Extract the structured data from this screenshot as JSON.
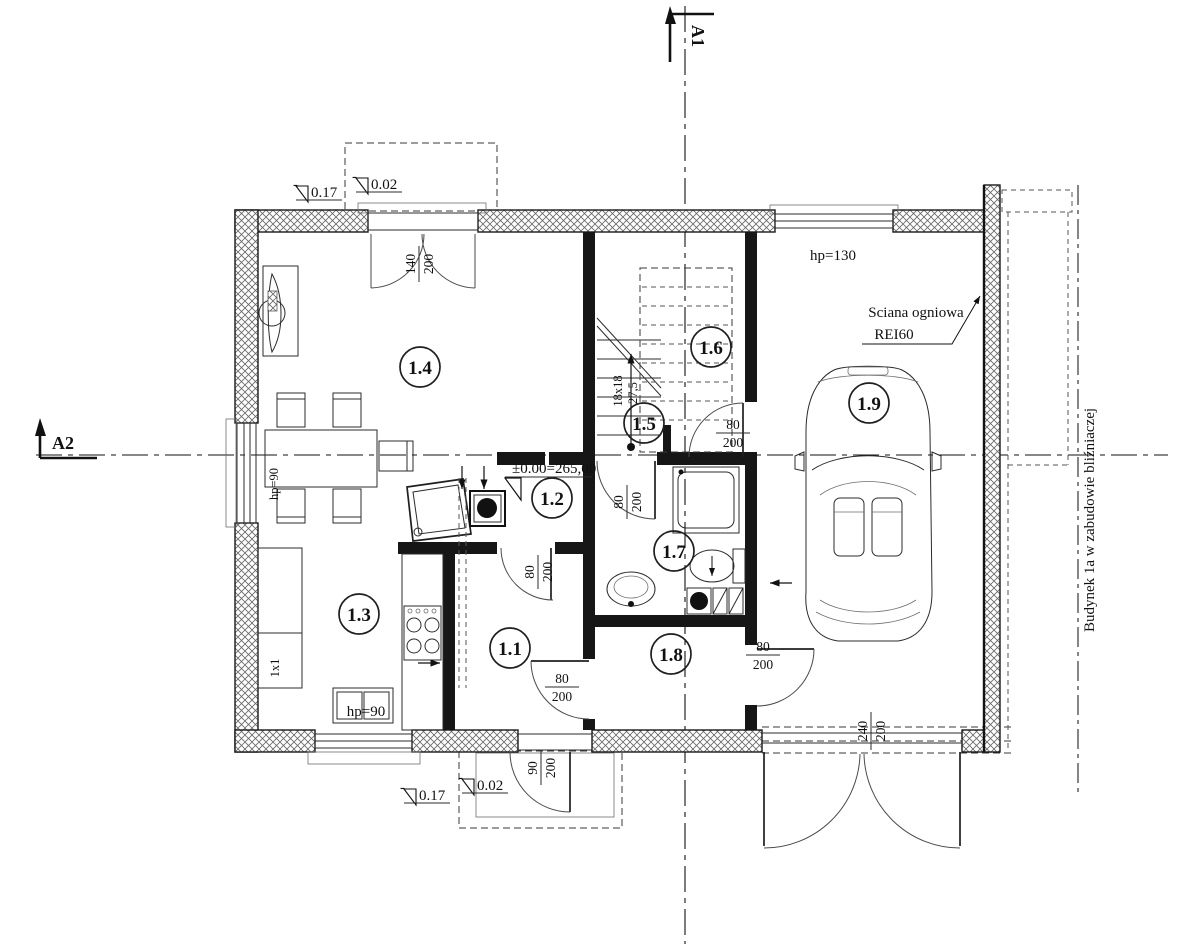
{
  "sections": {
    "a1": "A1",
    "a2": "A2"
  },
  "rooms": {
    "r11": "1.1",
    "r12": "1.2",
    "r13": "1.3",
    "r14": "1.4",
    "r15": "1.5",
    "r16": "1.6",
    "r17": "1.7",
    "r18": "1.8",
    "r19": "1.9"
  },
  "levels": {
    "minus": "-",
    "top_outer": "0.17",
    "top_inner": "0.02",
    "main": "±0.00=265,00",
    "bottom_inner": "0.02",
    "bottom_outer": "0.17"
  },
  "dims": {
    "balcony": {
      "w": "140",
      "h": "200"
    },
    "garage_door": {
      "w": "240",
      "h": "200"
    },
    "entrance": {
      "w": "90",
      "h": "200"
    },
    "door16": {
      "w": "80",
      "h": "200"
    },
    "door_bath": {
      "w": "80",
      "h": "200"
    },
    "door11": {
      "w": "80",
      "h": "200"
    },
    "door18a": {
      "w": "80",
      "h": "200"
    },
    "door18b": {
      "w": "80",
      "h": "200"
    }
  },
  "annotations": {
    "hp130": "hp=130",
    "hp90_window": "hp=90",
    "hp90_sink": "hp=90",
    "firewall_line1": "Sciana ogniowa",
    "firewall_line2": "REI60",
    "stair_steps": "18x18",
    "stair_tread": "27,5",
    "boundary": "Budynek 1a w zabudowie bliźniaczej",
    "kitchen_note": "1x1"
  }
}
